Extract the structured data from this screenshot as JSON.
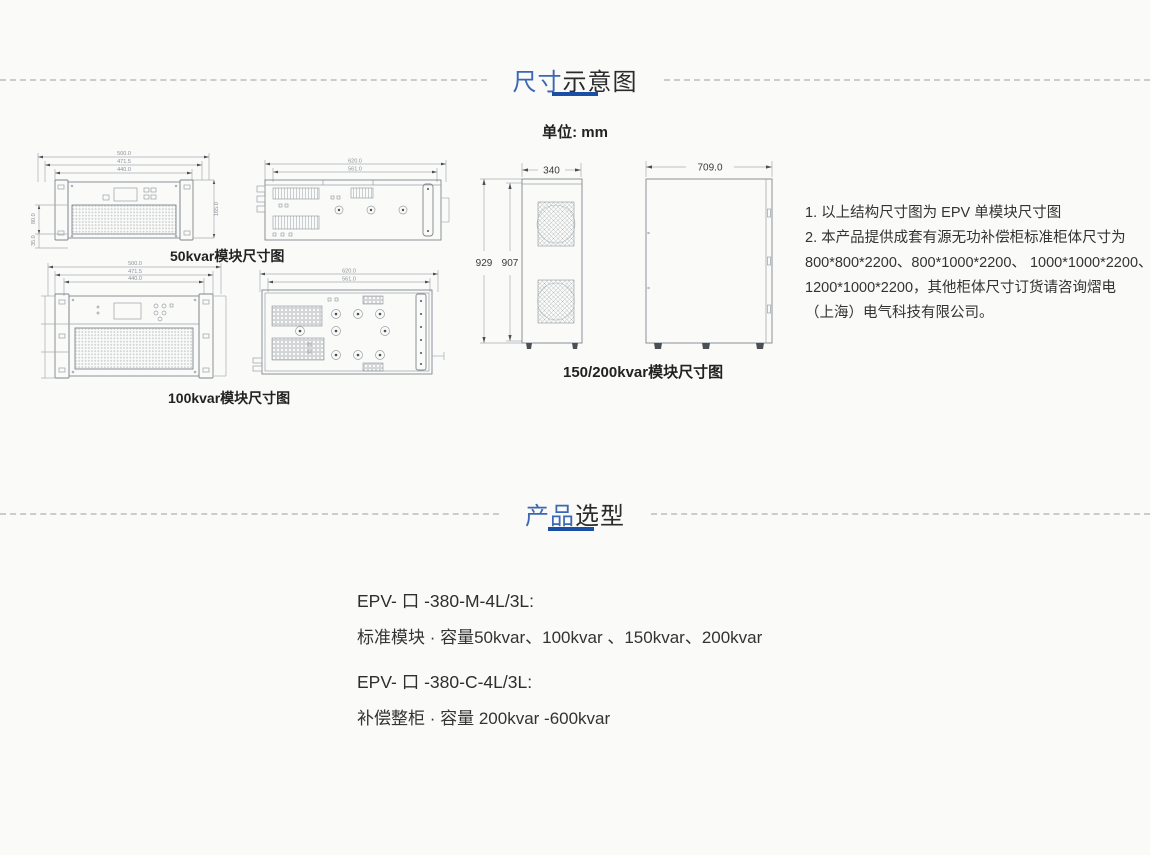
{
  "colors": {
    "accent_blue": "#1b4fa5",
    "heading_blue": "#3a68b2",
    "text_dark": "#333333",
    "dash_gray": "#cccccc"
  },
  "headings": {
    "dim": {
      "hl": "尺寸",
      "rest": "示意图"
    },
    "sel": {
      "hl": "产品",
      "rest": "选型"
    },
    "unit": "单位:  mm"
  },
  "labels": {
    "m50": "50kvar模块尺寸图",
    "m100": "100kvar模块尺寸图",
    "m150": "150/200kvar模块尺寸图"
  },
  "dims": {
    "m50f": [
      "500.0",
      "471.5",
      "440.0"
    ],
    "m50f_l": [
      "80.0",
      "35.0"
    ],
    "m50f_r": "165.0",
    "m50s": [
      "620.0",
      "561.0"
    ],
    "m100f": [
      "500.0",
      "471.5",
      "440.0"
    ],
    "m100t": [
      "620.0",
      "561.0"
    ],
    "m150f_w": "340",
    "m150f_h_outer": "929",
    "m150f_h_inner": "907",
    "m150s_w": "709.0"
  },
  "notes": [
    "1. 以上结构尺寸图为 EPV 单模块尺寸图",
    "2. 本产品提供成套有源无功补偿柜标准柜体尺寸为",
    "800*800*2200、800*1000*2200、 1000*1000*2200、",
    "1200*1000*2200，其他柜体尺寸订货请咨询熠电",
    "（上海）电气科技有限公司。"
  ],
  "products": [
    {
      "model": "EPV- 口 -380-M-4L/3L:",
      "desc": "标准模块 · 容量50kvar、100kvar 、150kvar、200kvar"
    },
    {
      "model": "EPV- 口 -380-C-4L/3L:",
      "desc": "补偿整柜 · 容量 200kvar -600kvar"
    }
  ]
}
